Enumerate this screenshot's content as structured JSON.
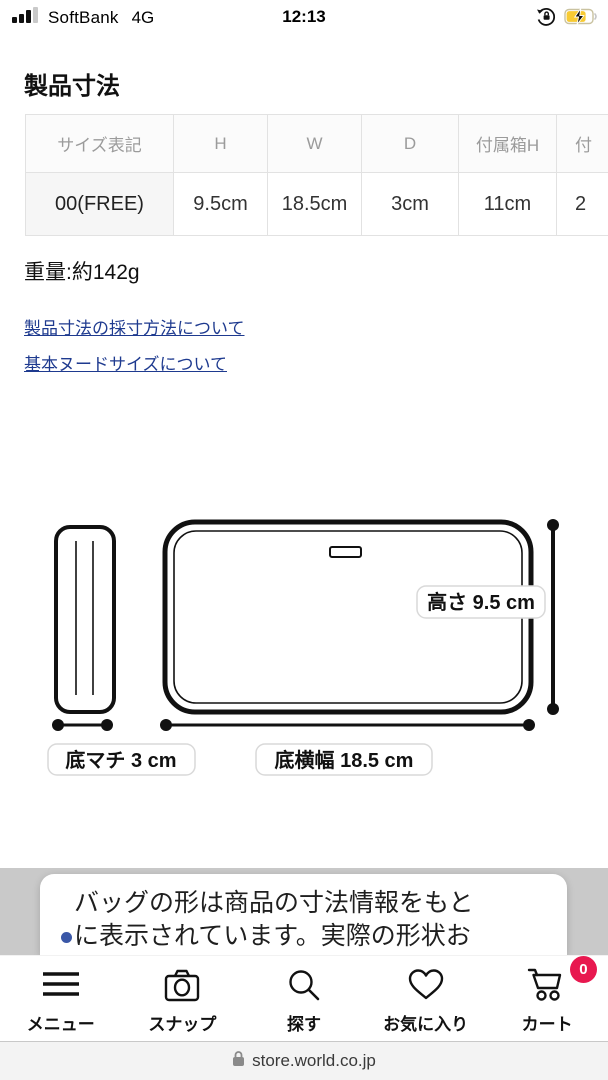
{
  "status_bar": {
    "carrier": "SoftBank",
    "network": "4G",
    "time": "12:13"
  },
  "page": {
    "title": "製品寸法",
    "size_table": {
      "headers": [
        "サイズ表記",
        "H",
        "W",
        "D",
        "付属箱H",
        "付"
      ],
      "row": [
        "00(FREE)",
        "9.5cm",
        "18.5cm",
        "3cm",
        "11cm",
        "2"
      ]
    },
    "weight": "重量:約142g",
    "links": [
      {
        "label": "製品寸法の採寸方法について"
      },
      {
        "label": "基本ヌードサイズについて"
      }
    ],
    "diagram": {
      "height_label": "高さ 9.5 cm",
      "depth_label": "底マチ 3 cm",
      "width_label": "底横幅 18.5 cm"
    },
    "notice": {
      "line1": "バッグの形は商品の寸法情報をもと",
      "line2": "に表示されています。実際の形状お"
    }
  },
  "nav": {
    "items": [
      {
        "label": "メニュー"
      },
      {
        "label": "スナップ"
      },
      {
        "label": "探す"
      },
      {
        "label": "お気に入り"
      },
      {
        "label": "カート",
        "badge": "0"
      }
    ]
  },
  "browser": {
    "url": "store.world.co.jp"
  },
  "colors": {
    "accent_badge": "#e8184f",
    "link": "#1e3a8f",
    "battery_fill": "#ffd60a"
  }
}
